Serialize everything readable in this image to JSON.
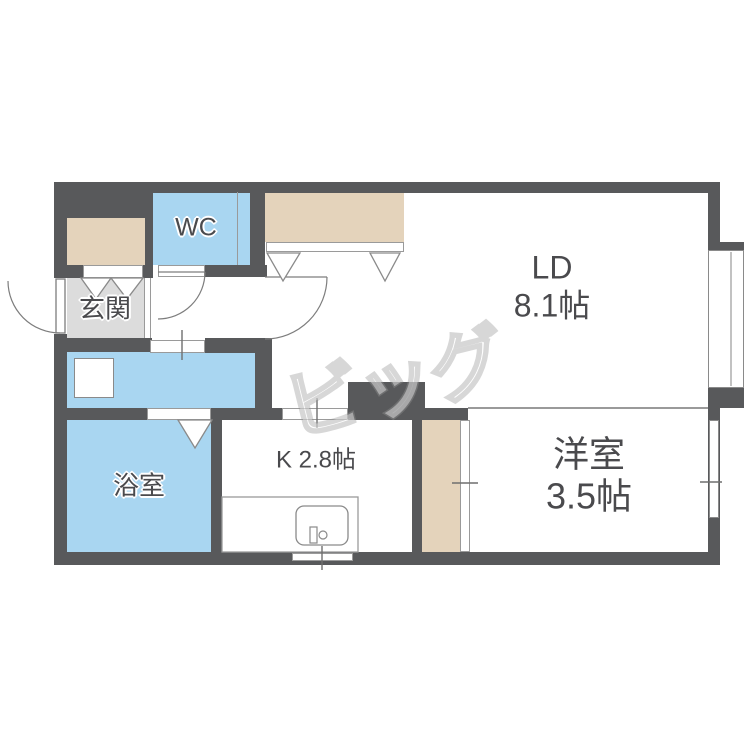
{
  "watermark": {
    "text": "ビッグ"
  },
  "rooms": {
    "wc": {
      "label": "WC"
    },
    "genkan": {
      "label": "玄関"
    },
    "bathroom": {
      "label": "浴室"
    },
    "kitchen": {
      "label": "K 2.8帖"
    },
    "living_dining": {
      "label": "LD",
      "size": "8.1帖"
    },
    "western_room": {
      "label": "洋室",
      "size": "3.5帖"
    }
  },
  "colors": {
    "wall": "#58595b",
    "wet_room_fill": "#a9d6f1",
    "closet_fill": "#e4d3bb",
    "genkan_fill": "#dcdcdc",
    "label_text": "#4a4a4d",
    "fixture_outline": "#7d7d7d"
  }
}
